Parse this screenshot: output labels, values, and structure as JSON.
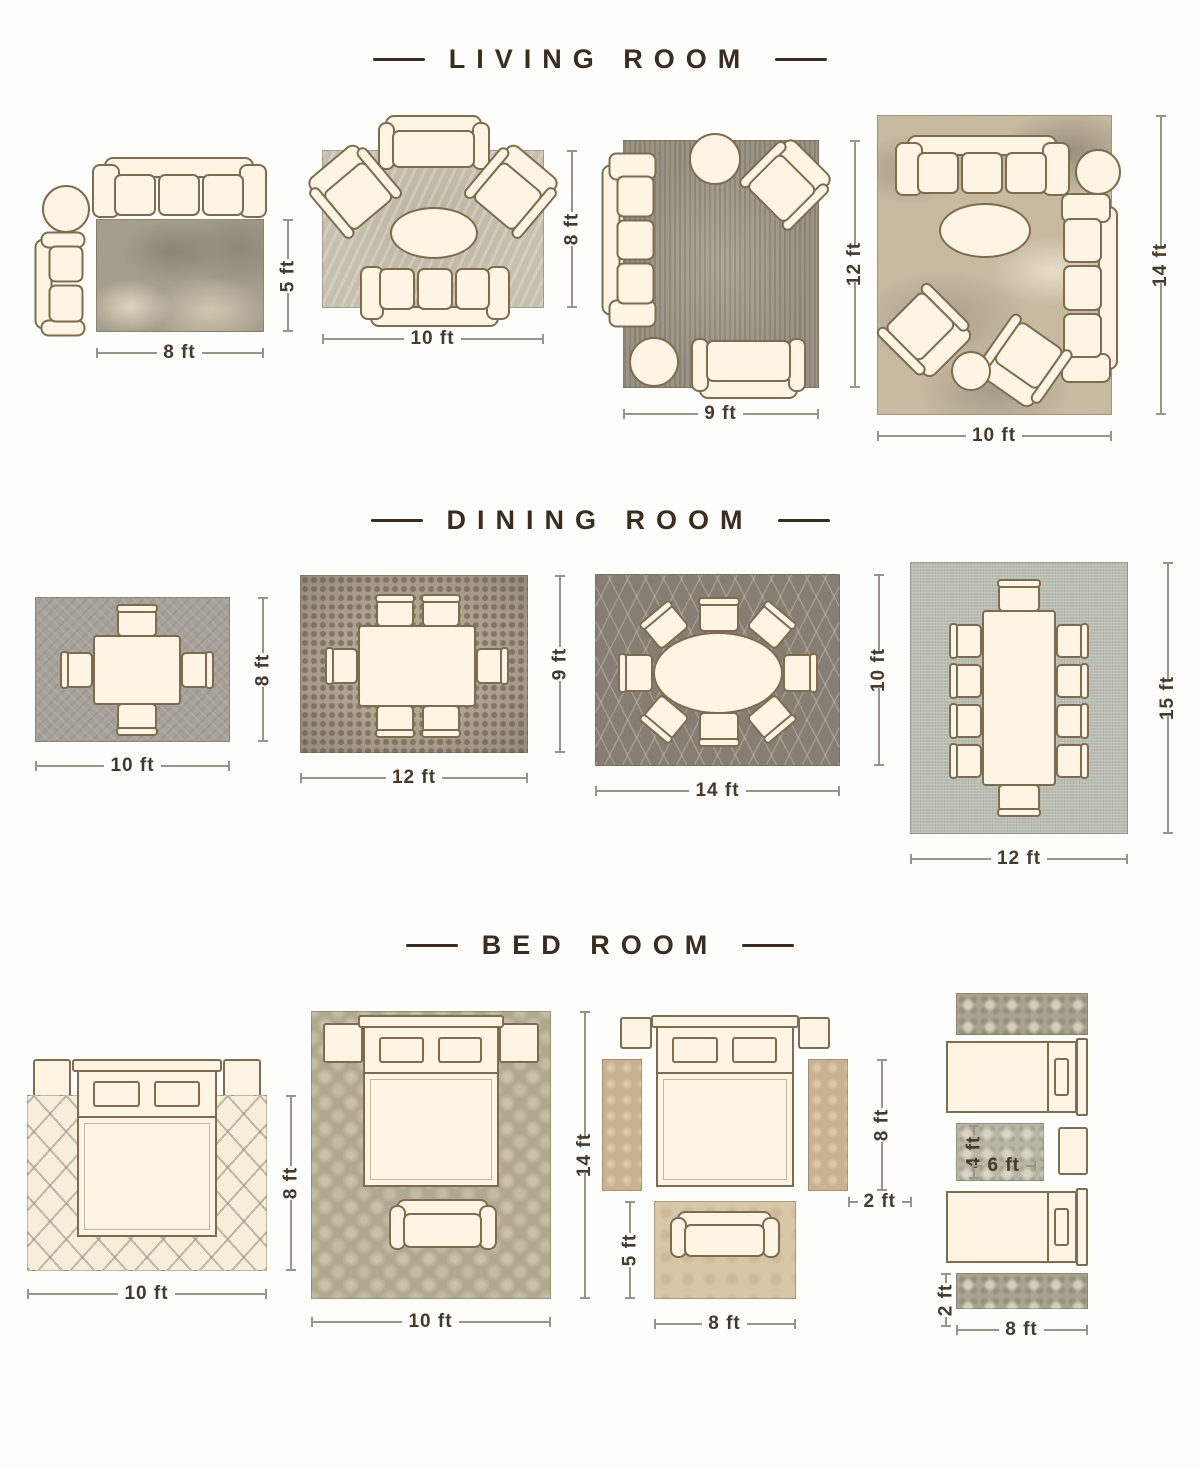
{
  "colors": {
    "title": "#3a2c1e",
    "dimension_label": "#453a2b",
    "dimension_line": "#9a948a",
    "furniture_fill": "#fdf4e3",
    "furniture_outline": "#7d6c4f"
  },
  "sections": [
    {
      "title": "LIVING ROOM",
      "layouts": [
        {
          "width_label": "8 ft",
          "height_label": "5 ft"
        },
        {
          "width_label": "10 ft",
          "height_label": "8 ft"
        },
        {
          "width_label": "9 ft",
          "height_label": "12 ft"
        },
        {
          "width_label": "10 ft",
          "height_label": "14 ft"
        }
      ]
    },
    {
      "title": "DINING ROOM",
      "layouts": [
        {
          "width_label": "10 ft",
          "height_label": "8 ft"
        },
        {
          "width_label": "12 ft",
          "height_label": "9 ft"
        },
        {
          "width_label": "14 ft",
          "height_label": "10 ft"
        },
        {
          "width_label": "12 ft",
          "height_label": "15 ft"
        }
      ]
    },
    {
      "title": "BED ROOM",
      "layouts": [
        {
          "width_label": "10 ft",
          "height_label": "8 ft"
        },
        {
          "width_label": "10 ft",
          "height_label": "14 ft"
        },
        {
          "bed_rug_height_label": "8 ft",
          "runner_width_label": "2 ft",
          "foot_rug_height_label": "5 ft",
          "foot_rug_width_label": "8 ft"
        },
        {
          "mid_rug_height_label": "4 ft",
          "mid_rug_width_label": "6 ft",
          "runner_height_label": "2 ft",
          "runner_width_label": "8 ft"
        }
      ]
    }
  ]
}
